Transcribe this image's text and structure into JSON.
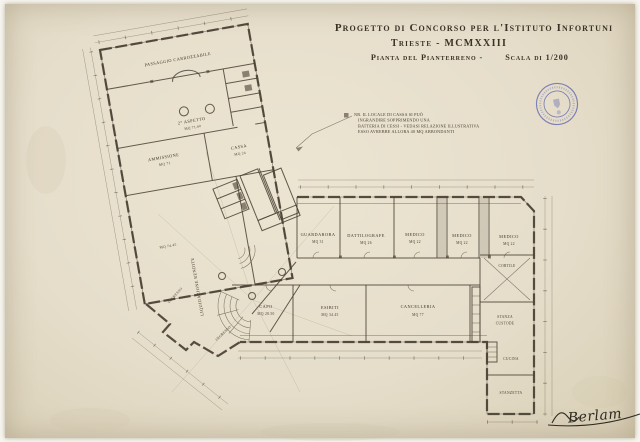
{
  "sheet": {
    "title_line1": "Progetto di Concorso per l'Istituto Infortuni",
    "title_line2": "Trieste - MCMXXIII",
    "title_line3a": "Pianta del Pianterreno -",
    "title_line3b": "Scala di 1/200",
    "signature": "Berlam"
  },
  "note": {
    "l1": "NB. IL LOCALE DI CASSA SI PUÒ",
    "l2": "INGRANDIRE SOPPRIMENDO UNA",
    "l3": "BATTERIA DI CESSI - VEDASI RELAZIONE ILLUSTRATIVA",
    "l4": "ESSO AVREBBE ALLORA 40 MQ ABBONDANTI"
  },
  "rooms": {
    "passaggio": {
      "label": "PASSAGGIO  CARROZZABILE"
    },
    "aspetto": {
      "label": "2° ASPETTO",
      "area": "MQ 71.60"
    },
    "cassa": {
      "label": "CASSA",
      "area": "MQ 24"
    },
    "ammissione": {
      "label": "AMMISSIONE",
      "area": "MQ 71"
    },
    "liquidazione": {
      "label": "LIQUIDAZIONE  RENDITE",
      "area": "MQ 74.45"
    },
    "ingresso1": {
      "label": "INGRESSO"
    },
    "ingresso2": {
      "label": "INGRESSO"
    },
    "guardaroba": {
      "label": "GUARDAROBA",
      "area": "MQ 31"
    },
    "dattilografe": {
      "label": "DATTILOGRAFE",
      "area": "MQ 26"
    },
    "medico1": {
      "label": "MEDICO",
      "area": "MQ 22"
    },
    "medico2": {
      "label": "MEDICO",
      "area": "MQ 22"
    },
    "medico3": {
      "label": "MEDICO",
      "area": "MQ 22"
    },
    "capo": {
      "label": "CAPO",
      "area": "MQ 28.50"
    },
    "esibiti": {
      "label": "ESIBITI",
      "area": "MQ 34.45"
    },
    "cancelleria": {
      "label": "CANCELLERIA",
      "area": "MQ 77"
    },
    "custode": {
      "l1": "STANZA",
      "l2": "CUSTODE"
    },
    "cortile": {
      "label": "CORTILE"
    },
    "cucina": {
      "label": "CUCINA"
    },
    "stanzetta": {
      "label": "STANZETTA"
    }
  }
}
